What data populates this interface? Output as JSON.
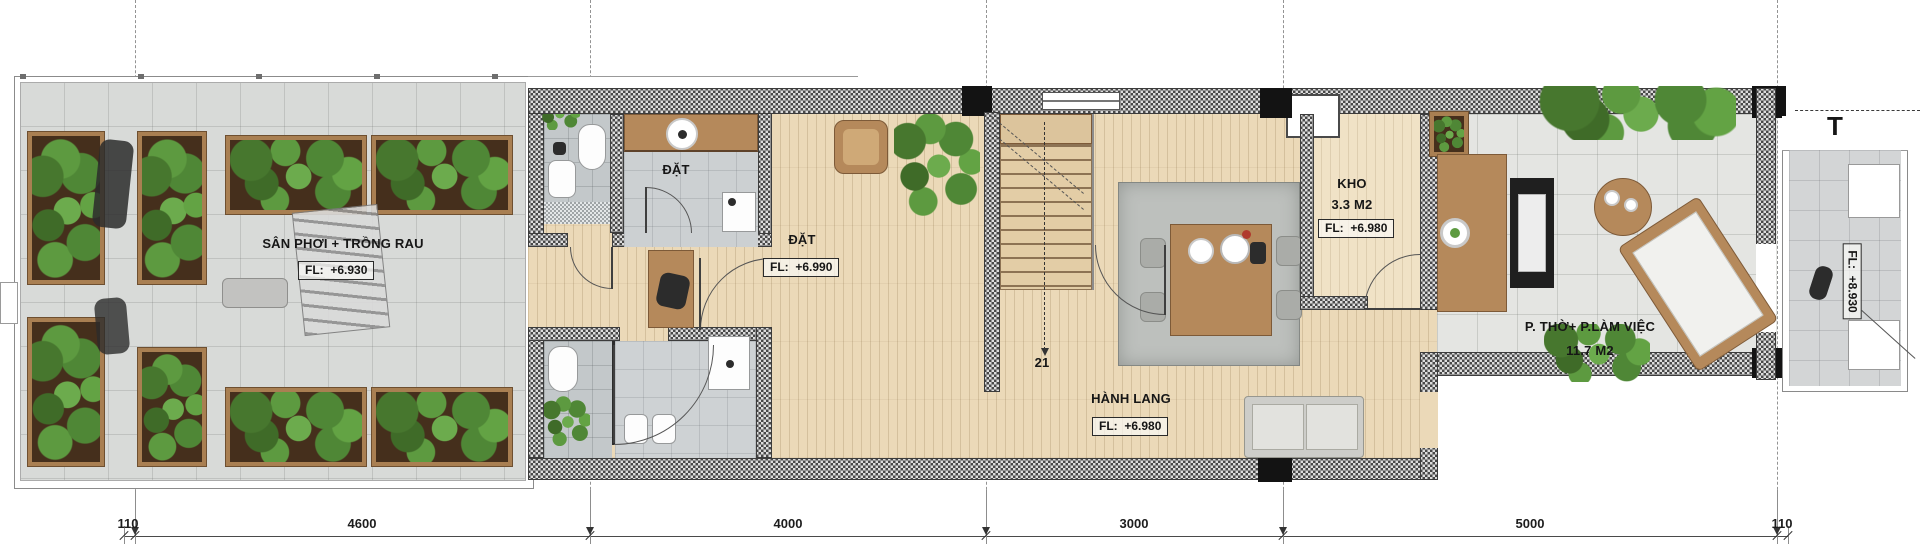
{
  "plan": {
    "terrace": {
      "label": "SÂN PHƠI + TRỒNG RAU",
      "fl": "FL:  +6.930"
    },
    "laundry_nook": {
      "label": "ĐẶT"
    },
    "hall": {
      "label": "ĐẶT",
      "fl": "FL:  +6.990"
    },
    "storage": {
      "label": "KHO",
      "area": "3.3 M2",
      "fl": "FL:  +6.980"
    },
    "corridor": {
      "label": "HÀNH LANG",
      "fl": "FL:  +6.980"
    },
    "worship_office": {
      "label": "P. THỜ+ P.LÀM VIỆC",
      "area": "11.7 M2"
    },
    "balcony": {
      "fl": "FL:  +8.930"
    },
    "stairs": {
      "step_count": "21"
    },
    "section_marker": "T"
  },
  "dimensions": {
    "bottom": [
      {
        "label": "110"
      },
      {
        "label": "4600"
      },
      {
        "label": "4000"
      },
      {
        "label": "3000"
      },
      {
        "label": "5000"
      },
      {
        "label": "110"
      }
    ]
  },
  "colors": {
    "wood_floor": "#ebd9b8",
    "tile_floor": "#d8dad8",
    "wall_hatch": "#474747",
    "plant_green": "#4f8736",
    "furniture_wood": "#b5895b"
  }
}
